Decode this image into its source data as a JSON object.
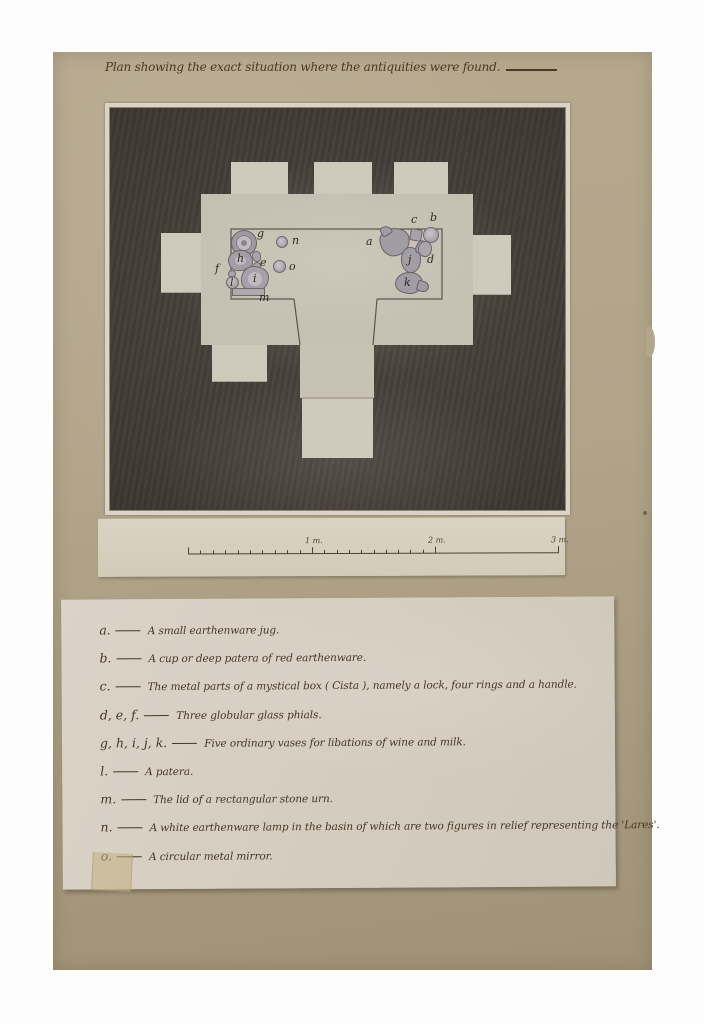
{
  "title": "Plan showing the exact situation where the antiquities were found.",
  "plan": {
    "objects": [
      {
        "name": "artifact-g-vase",
        "shape": "ring",
        "x": 121,
        "y": 122,
        "w": 26,
        "h": 26,
        "label": "g",
        "lx": 147,
        "ly": 120
      },
      {
        "name": "artifact-n-lamp",
        "shape": "circle",
        "x": 166,
        "y": 128,
        "w": 12,
        "h": 12,
        "label": "n",
        "lx": 182,
        "ly": 127
      },
      {
        "name": "artifact-h-vase",
        "shape": "blob",
        "x": 118,
        "y": 142,
        "w": 25,
        "h": 21,
        "label": "h",
        "lx": 127,
        "ly": 145
      },
      {
        "name": "artifact-e-phial",
        "shape": "bits",
        "x": 142,
        "y": 143,
        "w": 8,
        "h": 18,
        "label": "e",
        "lx": 150,
        "ly": 149
      },
      {
        "name": "artifact-o-mirror",
        "shape": "circle",
        "x": 163,
        "y": 152,
        "w": 13,
        "h": 13,
        "label": "o",
        "lx": 179,
        "ly": 153
      },
      {
        "name": "artifact-f-phial",
        "shape": "dot",
        "x": 118,
        "y": 162,
        "w": 8,
        "h": 8,
        "label": "f",
        "lx": 105,
        "ly": 155
      },
      {
        "name": "artifact-l-patera",
        "shape": "circle",
        "x": 116,
        "y": 168,
        "w": 13,
        "h": 13,
        "label": "l",
        "lx": 120,
        "ly": 169
      },
      {
        "name": "artifact-i-vase",
        "shape": "blob2",
        "x": 131,
        "y": 158,
        "w": 28,
        "h": 26,
        "label": "i",
        "lx": 143,
        "ly": 165
      },
      {
        "name": "artifact-m-lid",
        "shape": "bar",
        "x": 122,
        "y": 180,
        "w": 33,
        "h": 8,
        "label": "m",
        "lx": 149,
        "ly": 184
      },
      {
        "name": "artifact-a-jug",
        "shape": "jug",
        "x": 270,
        "y": 120,
        "w": 30,
        "h": 28,
        "label": "a",
        "lx": 256,
        "ly": 128
      },
      {
        "name": "artifact-c-cista",
        "shape": "square",
        "x": 300,
        "y": 121,
        "w": 12,
        "h": 12,
        "label": "c",
        "lx": 301,
        "ly": 106
      },
      {
        "name": "artifact-b-patera",
        "shape": "circle",
        "x": 313,
        "y": 119,
        "w": 16,
        "h": 16,
        "label": "b",
        "lx": 320,
        "ly": 104
      },
      {
        "name": "artifact-j-vase",
        "shape": "vase",
        "x": 291,
        "y": 139,
        "w": 20,
        "h": 26,
        "label": "j",
        "lx": 298,
        "ly": 146
      },
      {
        "name": "artifact-d-phial",
        "shape": "phial",
        "x": 308,
        "y": 133,
        "w": 14,
        "h": 16,
        "label": "d",
        "lx": 317,
        "ly": 146
      },
      {
        "name": "artifact-k-vase",
        "shape": "jug2",
        "x": 285,
        "y": 164,
        "w": 28,
        "h": 22,
        "label": "k",
        "lx": 294,
        "ly": 169
      }
    ]
  },
  "scale": {
    "labels": [
      "1 m.",
      "2 m.",
      "3 m."
    ],
    "minor_divisions_per_meter": 10,
    "meters_with_minor_ticks": 2
  },
  "legend": {
    "rows": [
      {
        "letters": "a.",
        "text": "A small earthenware jug."
      },
      {
        "letters": "b.",
        "text": "A cup or deep patera of red earthenware."
      },
      {
        "letters": "c.",
        "text": "The metal parts of a mystical box ( Cista ), namely a lock, four rings and a handle."
      },
      {
        "letters": "d, e, f.",
        "text": "Three globular glass phials."
      },
      {
        "letters": "g, h, i, j, k.",
        "text": "Five ordinary vases for libations of wine and milk."
      },
      {
        "letters": "l.",
        "text": "A patera."
      },
      {
        "letters": "m.",
        "text": "The lid of a rectangular stone urn."
      },
      {
        "letters": "n.",
        "text": "A white earthenware lamp in the basin of which are two figures in relief representing the 'Lares'."
      },
      {
        "letters": "o.",
        "text": "A circular metal mirror."
      }
    ]
  }
}
